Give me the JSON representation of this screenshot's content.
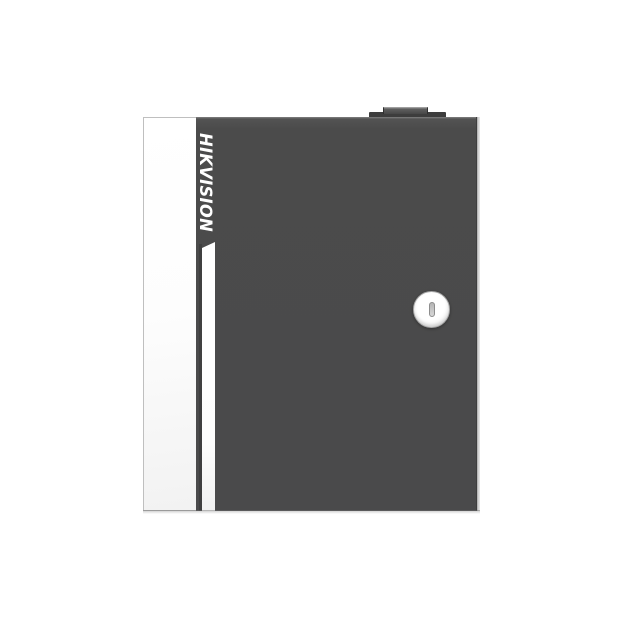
{
  "background_color": "#ffffff",
  "device": {
    "brand": "HIKVISION",
    "type": "metal enclosure front view with locked door",
    "colors": {
      "front_panel": "#4b4b4b",
      "door_edge_panel": "#fcfcfc",
      "accent_stripe": "#ffffff",
      "logo_text": "#ffffff",
      "side_edge_highlight": "#d8d8d8",
      "top_tab": "#3d3d3d",
      "lock_face": "#ffffff",
      "keyhole_slot": "#c5c5c5"
    },
    "features": {
      "logo_orientation": "rotated 90deg clockwise, reads top to bottom",
      "lock_label": "cam lock with vertical keyhole slot",
      "top_tab_label": "hinge/tamper tab on top edge"
    }
  }
}
